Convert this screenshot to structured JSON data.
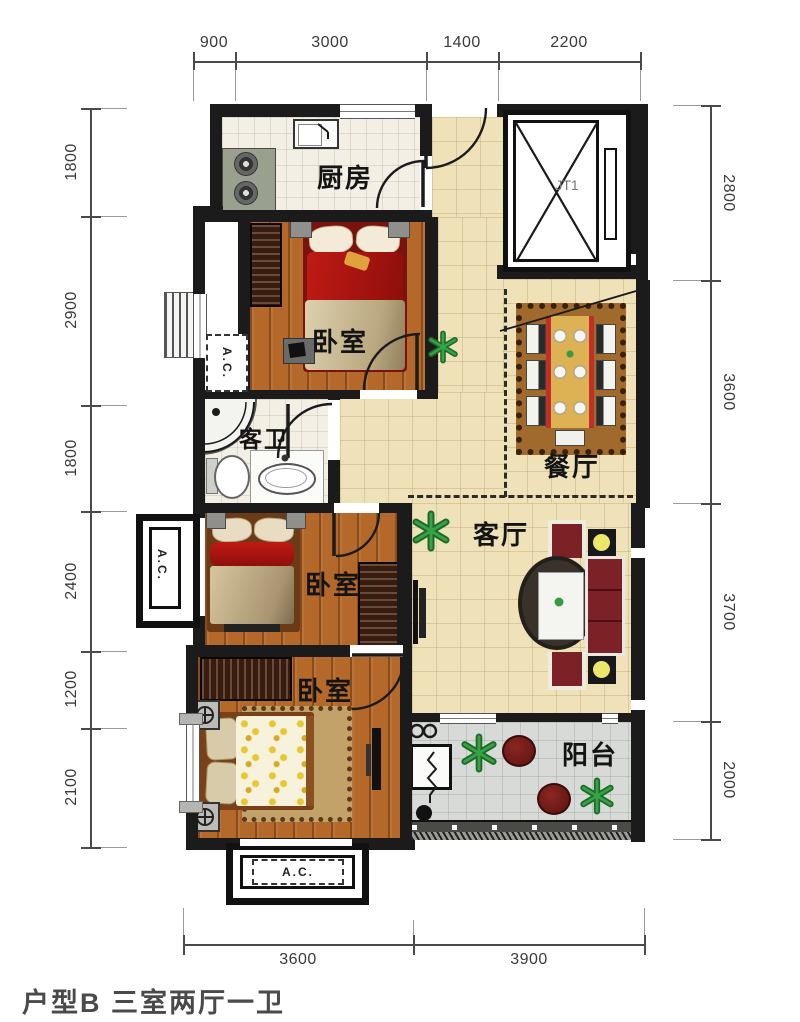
{
  "caption": "户型B 三室两厅一卫",
  "dimensions": {
    "top": [
      "900",
      "3000",
      "1400",
      "2200"
    ],
    "left": [
      "1800",
      "2900",
      "1800",
      "2400",
      "1200",
      "2100"
    ],
    "right": [
      "2800",
      "3600",
      "3700",
      "2000"
    ],
    "bottom": [
      "3600",
      "3900"
    ]
  },
  "rooms": {
    "kitchen": "厨房",
    "bedroom_top": "卧室",
    "bedroom_middle": "卧室",
    "bedroom_bottom": "卧室",
    "bathroom": "客卫",
    "dining": "餐厅",
    "living": "客厅",
    "balcony": "阳台",
    "elevator": "JT1"
  },
  "annotations": {
    "ac_upper": "A.C.",
    "ac_left": "A.C.",
    "ac_bottom": "A.C."
  },
  "colors": {
    "wall": "#1b1b1b",
    "beige_tile": "#efe2b8",
    "white_tile": "#f4efe4",
    "gray_tile": "#d7dad6",
    "wood_floor": "#b4692a",
    "bed_red": "#b01512",
    "sofa_red": "#7c2126",
    "plant_green": "#2f8f3a",
    "lamp_yellow": "#ece768"
  }
}
